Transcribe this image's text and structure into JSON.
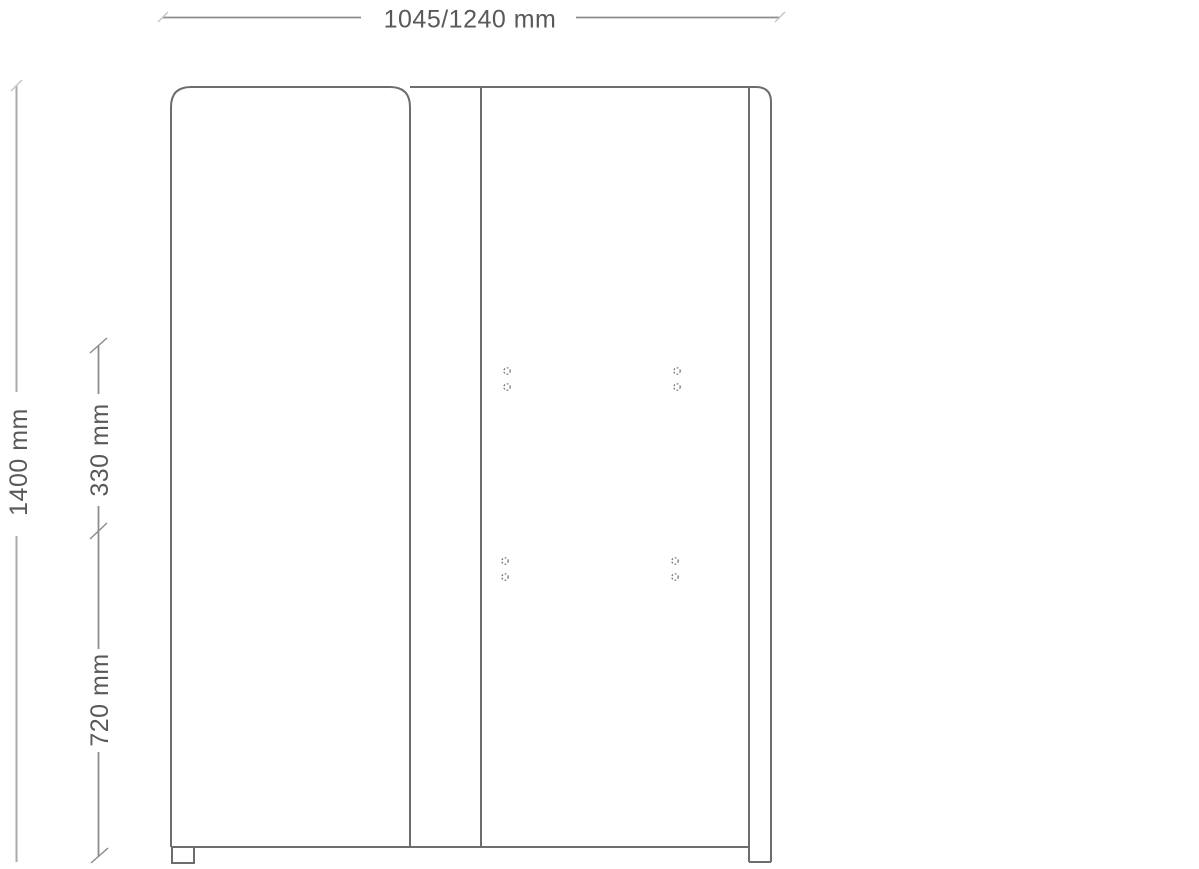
{
  "labels": {
    "width": "1045/1240 mm",
    "height": "1400 mm",
    "upper_segment": "330 mm",
    "lower_segment": "720 mm"
  },
  "colors": {
    "outline": "#6b6d70",
    "dimension_line": "#8a8c8f",
    "dimension_line_light": "#a9abae",
    "tick_faint": "#c6c7c9",
    "text": "#58595b",
    "background": "#ffffff"
  },
  "drawing": {
    "type": "technical-dimension-drawing",
    "subject": "cabinet-front-elevation",
    "mounting_holes": {
      "radius": 3.2,
      "positions": [
        [
          507,
          371
        ],
        [
          507,
          387
        ],
        [
          677,
          371
        ],
        [
          677,
          387
        ],
        [
          505,
          561
        ],
        [
          505,
          577
        ],
        [
          675,
          561
        ],
        [
          675,
          577
        ]
      ]
    }
  }
}
